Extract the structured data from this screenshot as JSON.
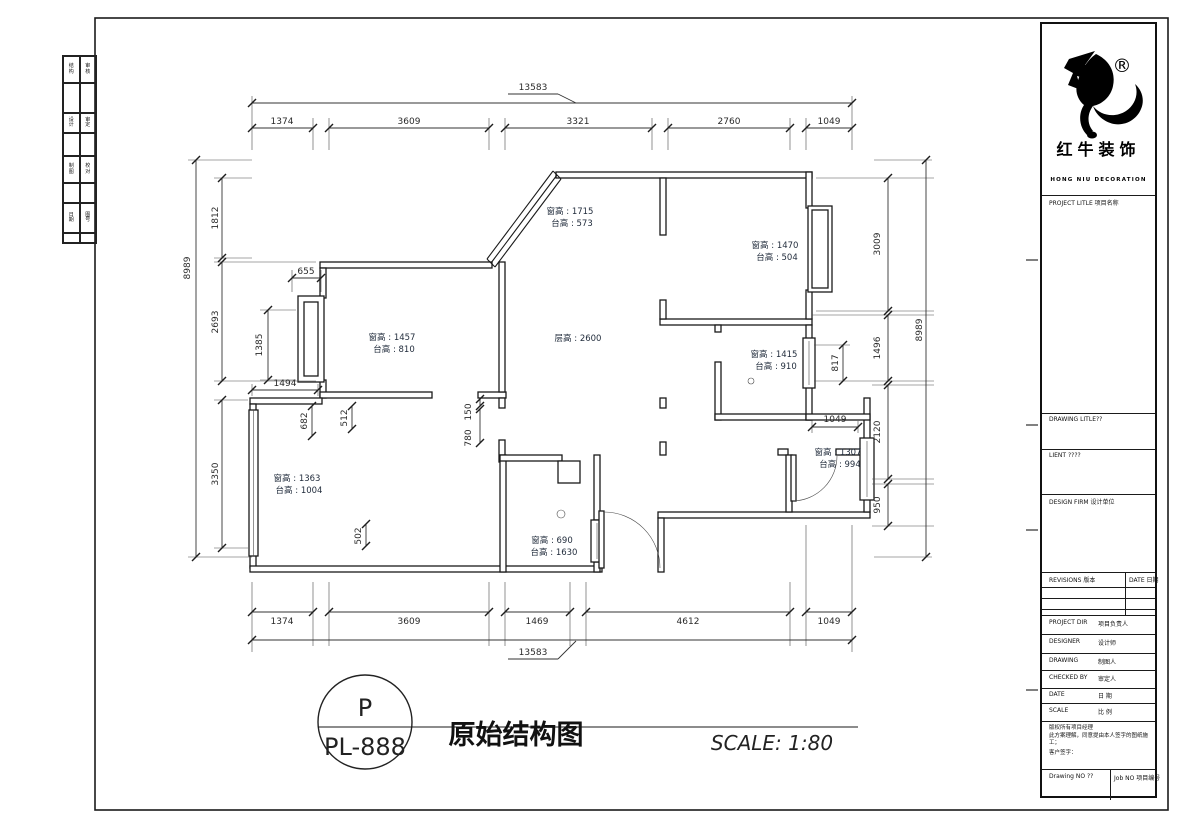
{
  "brand": {
    "name": "红牛装饰",
    "sub": "HONG NIU DECORATION",
    "reg": "®"
  },
  "titleblock": {
    "project_title": "PROJECT LITLE 项目名称",
    "drawing_title": "DRAWING LITLE??",
    "client": "LIENT ????",
    "design_firm": "DESIGN FIRM 设计单位",
    "revisions": "REVISIONS 版本",
    "date_col": "DATE 日期",
    "rows": [
      {
        "en": "PROJECT DIR",
        "zh": "项目负责人"
      },
      {
        "en": "DESIGNER",
        "zh": "设计师"
      },
      {
        "en": "DRAWING",
        "zh": "制图人"
      },
      {
        "en": "CHECKED BY",
        "zh": "审定人"
      },
      {
        "en": "DATE",
        "zh": "日 期"
      },
      {
        "en": "SCALE",
        "zh": "比 例"
      }
    ],
    "note1": "版权所有项目经理",
    "note2": "此方案理解，同意提由本人签字的图纸施工；",
    "note3": "客户签字：",
    "drawing_no": "Drawing NO ??",
    "job_no": "Job NO 项目编号"
  },
  "footer": {
    "badge_top": "P",
    "badge_no": "PL-888",
    "title": "原始结构图",
    "scale": "SCALE: 1:80"
  },
  "dims": {
    "top_total": "13583",
    "top": [
      "1374",
      "3609",
      "3321",
      "2760",
      "1049"
    ],
    "bottom_total": "13583",
    "bottom": [
      "1374",
      "3609",
      "1469",
      "4612",
      "1049"
    ],
    "left_total": "8989",
    "left": [
      "1812",
      "2693",
      "3350"
    ],
    "right_total": "8989",
    "right": [
      "3009",
      "1496",
      "2120",
      "950"
    ],
    "misc": {
      "a655": "655",
      "a1494": "1494",
      "a1385": "1385",
      "a682": "682",
      "a512": "512",
      "a150": "150",
      "a780": "780",
      "a502": "502",
      "a817": "817",
      "a1049": "1049"
    }
  },
  "plan": {
    "floor_height": "层高 : 2600",
    "windows": [
      {
        "h": "窗高 : 1715",
        "s": "台高 : 573"
      },
      {
        "h": "窗高 : 1470",
        "s": "台高 : 504"
      },
      {
        "h": "窗高 : 1457",
        "s": "台高 : 810"
      },
      {
        "h": "窗高 : 1415",
        "s": "台高 : 910"
      },
      {
        "h": "窗高 : 1363",
        "s": "台高 : 1004"
      },
      {
        "h": "窗高 : 1307",
        "s": "台高 : 994"
      },
      {
        "h": "窗高 : 690",
        "s": "台高 : 1630"
      }
    ]
  },
  "strip": {
    "labels": [
      "结构",
      "审核",
      "设计",
      "审定",
      "制图",
      "校对",
      "日期",
      "图号"
    ]
  }
}
